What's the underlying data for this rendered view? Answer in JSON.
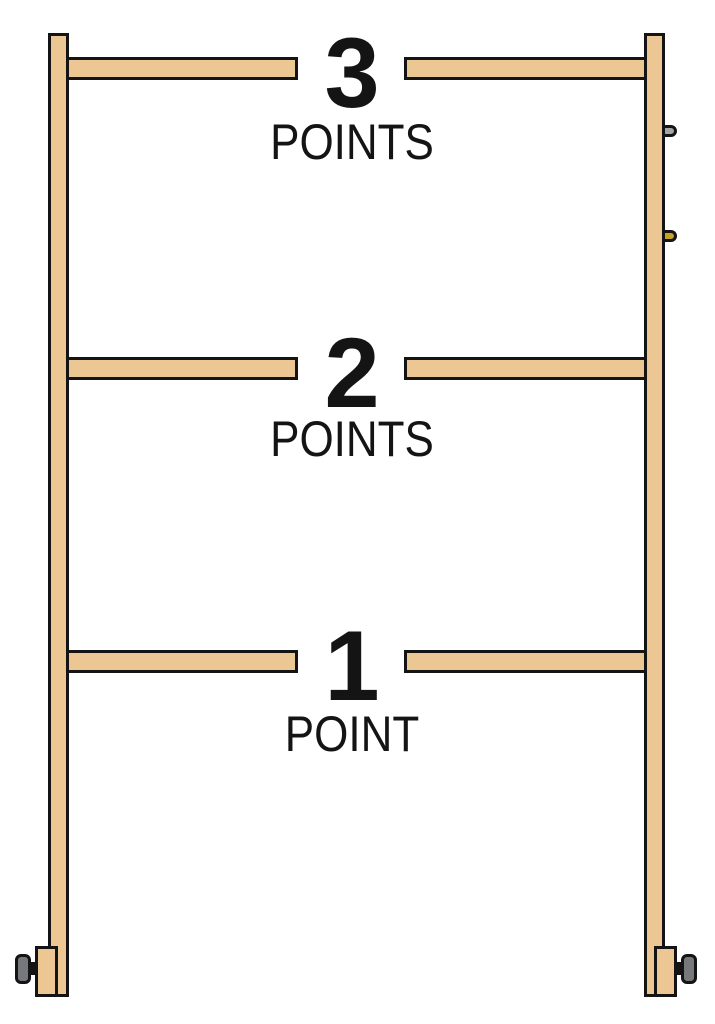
{
  "rungs": [
    {
      "points": "3",
      "label": "POINTS"
    },
    {
      "points": "2",
      "label": "POINTS"
    },
    {
      "points": "1",
      "label": "POINT"
    }
  ],
  "colors": {
    "background": "#FFFFFF",
    "wood": "#ECC794",
    "outline": "#141414",
    "text": "#141414",
    "knob": "#77787B",
    "peg_silver": "#A4A5A7",
    "peg_gold": "#C4A127"
  }
}
